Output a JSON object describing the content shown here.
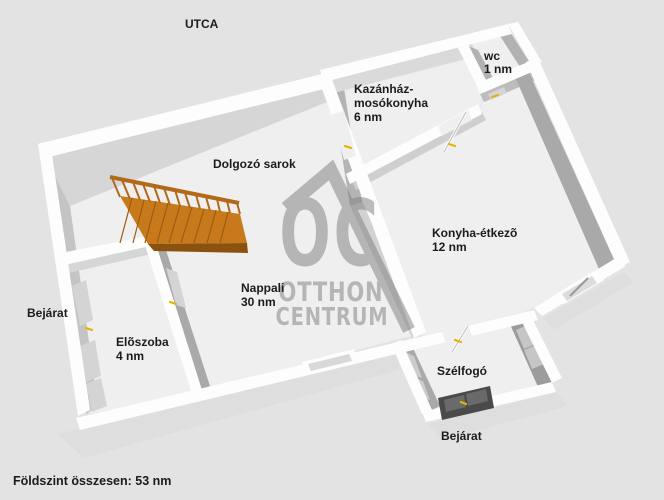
{
  "plan": {
    "street_label": "UTCA",
    "footer_total": "Földszint összesen: 53 nm",
    "watermark": {
      "logo_text": "OC",
      "brand_line1": "OTTHON",
      "brand_line2": "CENTRUM"
    },
    "rooms": {
      "wc": {
        "name": "wc",
        "area": "1 nm"
      },
      "kazanhaz_mosokonyha": {
        "name_line1": "Kazánház-",
        "name_line2": "mosókonyha",
        "area": "6 nm"
      },
      "dolgozo_sarok": {
        "name": "Dolgozó sarok"
      },
      "konyha_etkezo": {
        "name": "Konyha-étkezõ",
        "area": "12 nm"
      },
      "nappali": {
        "name": "Nappali",
        "area": "30 nm"
      },
      "eloszoba": {
        "name": "Elõszoba",
        "area": "4 nm"
      },
      "szelfogo": {
        "name": "Szélfogó"
      }
    },
    "entrances": {
      "left_label": "Bejárat",
      "front_label": "Bejárat"
    },
    "colors": {
      "background": "#e3e3e3",
      "floor": "#efefef",
      "wall_top": "#fdfdfd",
      "wall_shade_dark": "#a9a9a9",
      "stairs_orange": "#c8791c",
      "door_marker_yellow": "#e6b400",
      "watermark_gray": "#a9a9a9",
      "entry_door_dark": "#4a4a4a",
      "label_text": "#1b1b1b"
    }
  }
}
